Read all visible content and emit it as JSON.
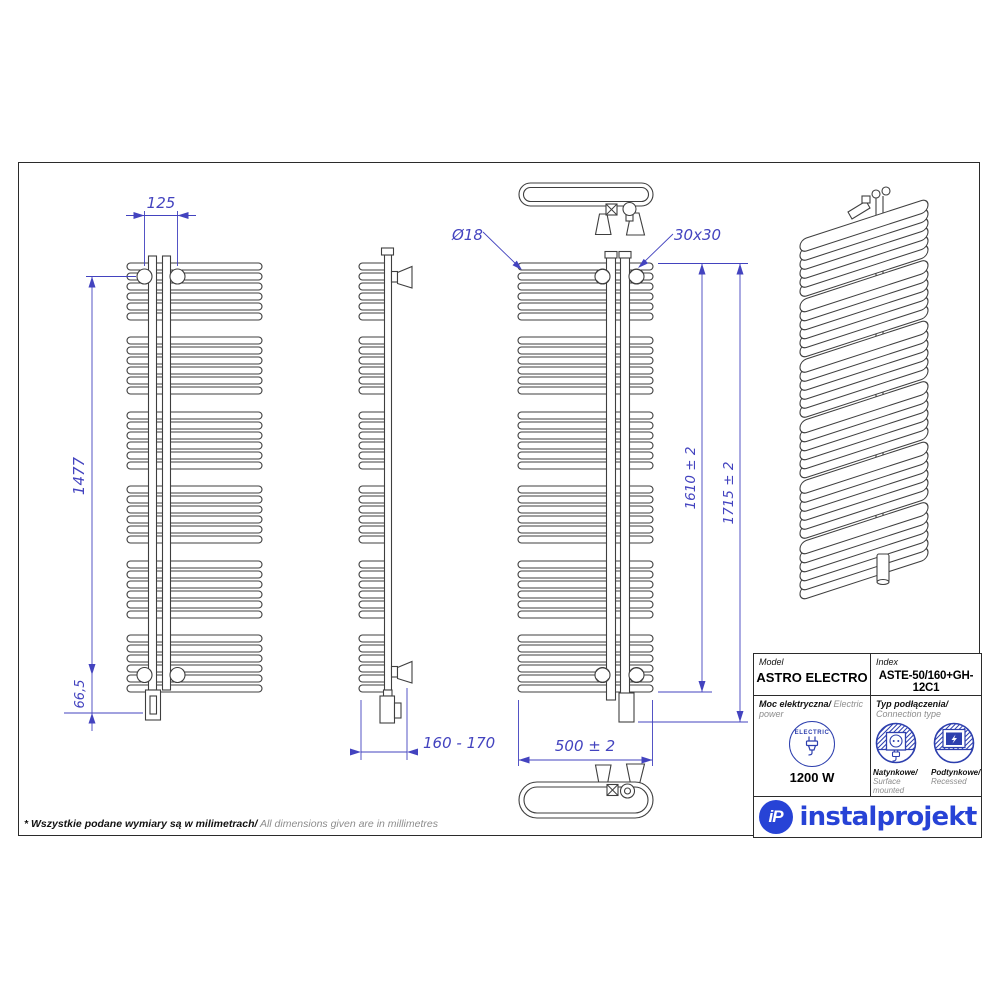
{
  "dims": {
    "pitch_top": "125",
    "axis_height": "1477",
    "bottom_offset": "66,5",
    "wall_distance": "160 - 170",
    "tube_diameter": "Ø18",
    "collector_profile": "30x30",
    "body_height": "1610 ± 2",
    "total_height": "1715 ± 2",
    "width": "500 ± 2"
  },
  "table": {
    "model_label": "Model",
    "model_value": "ASTRO ELECTRO",
    "index_label": "Index",
    "index_value": "ASTE-50/160+GH-12C1",
    "power_label_pl": "Moc elektryczna/",
    "power_label_en": " Electric power",
    "electric_badge": "ELECTRIC",
    "power_value": "1200 W",
    "connection_label_pl": "Typ podłączenia/",
    "connection_label_en": "Connection type",
    "surface_pl": "Natynkowe/",
    "surface_en": "Surface mounted",
    "recessed_pl": "Podtynkowe/",
    "recessed_en": "Recessed"
  },
  "logo": {
    "monogram": "iP",
    "wordmark": "instalprojekt"
  },
  "footer": {
    "note_pl": "* Wszystkie podane wymiary są w milimetrach/",
    "note_en": " All dimensions given are in millimetres"
  },
  "colors": {
    "dimension_blue": "#4343bf",
    "drawing_gray": "#3f3f3f",
    "brand_blue": "#2743d6",
    "icon_blue": "#2d3fae"
  }
}
